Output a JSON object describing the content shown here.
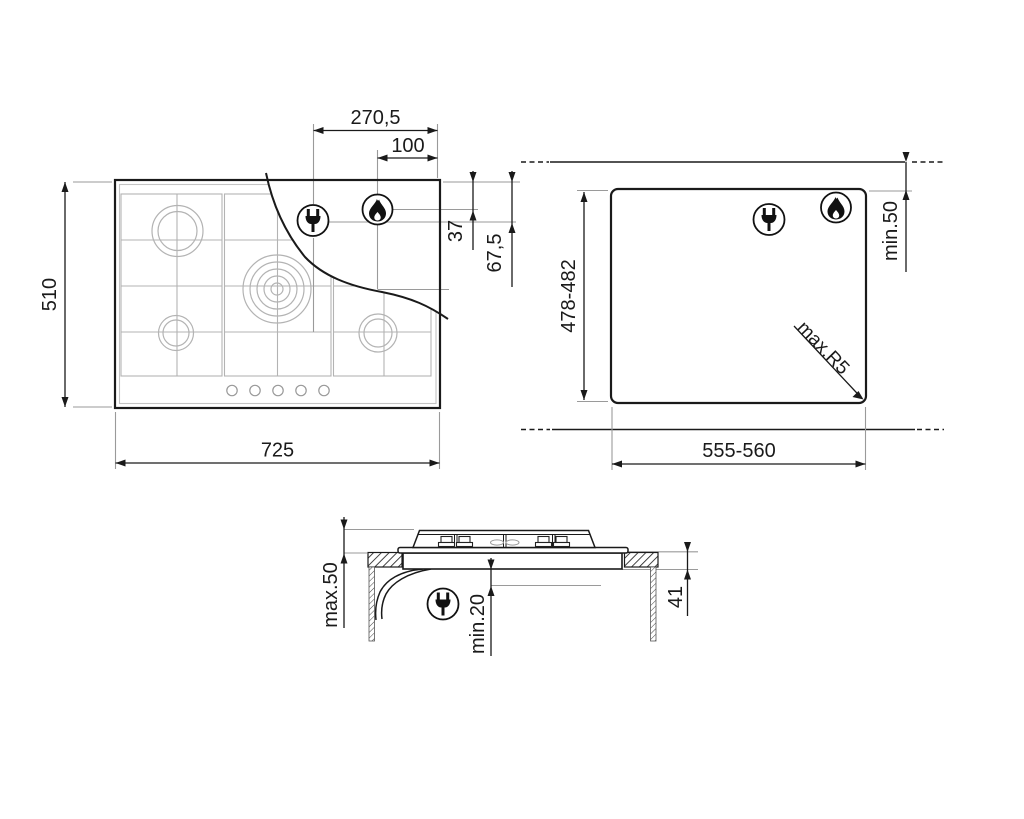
{
  "page": {
    "background": "#ffffff"
  },
  "colors": {
    "line": "#1a1a1a",
    "thin": "#9a9a9a",
    "grid": "#b3b3b3"
  },
  "icons": {
    "plug": "power-plug-icon",
    "flame": "gas-flame-icon"
  },
  "top_view": {
    "dim_plug_from_right_edge": "270,5",
    "dim_flame_from_right_edge": "100",
    "dim_flame_from_rear_edge": "37",
    "dim_plug_from_rear_edge": "67,5",
    "dim_overall_depth": "510",
    "dim_overall_width": "725"
  },
  "cutout_view": {
    "dim_cutout_depth": "478-482",
    "dim_cutout_width": "555-560",
    "dim_rear_clearance": "min.50",
    "dim_corner_radius": "max.R5"
  },
  "section_view": {
    "dim_height_above_worktop": "max.50",
    "dim_clearance_below": "min.20",
    "dim_depth_below_worktop": "41"
  }
}
